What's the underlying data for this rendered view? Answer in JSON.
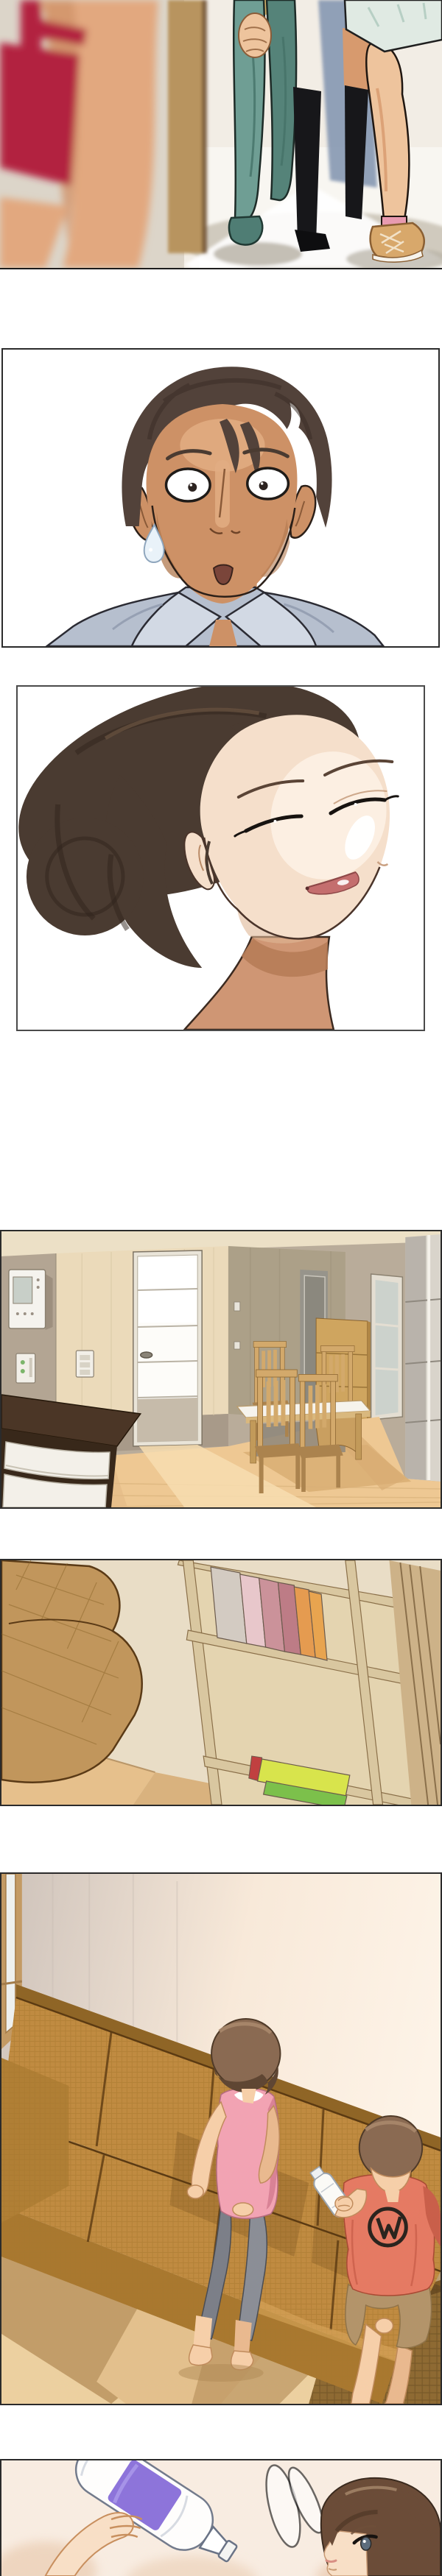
{
  "meta": {
    "type": "webtoon-comic-page",
    "panel_count": 7,
    "text_content": "none - wordless comic panels"
  },
  "icons": [
    "sweat-drop-icon",
    "motion-swirl-icon"
  ],
  "panels": [
    {
      "id": "panel-1",
      "alt": "Blurred woman in a red top in the foreground watching two people walk in through a bright doorway; teal jeans, black knee socks, tan sneaker with pink sock, pale mint skirt"
    },
    {
      "id": "panel-2",
      "alt": "Startled man with wide round eyes, small open mouth and a sweat drop on his cheek, wearing a pale blue collared shirt"
    },
    {
      "id": "panel-3",
      "alt": "Smiling woman with closed eyes, dark brown hair swept into a low bun, rose lips"
    },
    {
      "id": "panel-4",
      "alt": "Empty apartment interior: white paneled door, taupe walls with intercom and switches, wooden dining table with slat-back chairs, white shelving, dark counter with white drawers"
    },
    {
      "id": "panel-5",
      "alt": "Tilted view of a light wood bookshelf holding white, pink, rose and orange books with lime green books below, next to a woven tan sofa"
    },
    {
      "id": "panel-6",
      "alt": "Woman in a pink tank top and gray leggings and a boy in a coral tee holding a white bottle, sitting on a long woven brown sofa against a peach wall"
    },
    {
      "id": "panel-7",
      "alt": "Girl in profile looking up at an upside-down clear bottle with a purple band, with a swirl motion mark beside it"
    }
  ],
  "palette": {
    "paper": "#ffffff",
    "ink": "#241f1a",
    "p1-bg-left": "#dcd5c9",
    "p1-bg-right": "#f2ede5",
    "p1-floor": "#f8f6f1",
    "p1-doorframe": "#b8945f",
    "p1-doorframe-edge": "#6b4e2e",
    "p1-red": "#b22340",
    "p1-skin-blur": "#e2a87f",
    "p1-jeans": "#6f9e94",
    "p1-jeans-dark": "#558379",
    "p1-shoe-teal": "#4f7d74",
    "p1-shadow-blue": "#8093af",
    "p1-skin": "#eec49d",
    "p1-skin-shadow": "#d79a6e",
    "p1-sock-black": "#17171a",
    "p1-skirt": "#e0eae3",
    "p1-sock-pink": "#e89bb0",
    "p1-sneaker": "#d8a86b",
    "p1-shadow-warm": "#c7bfb2",
    "p2-hair": "#52423a",
    "p2-hair-dark": "#3a2e27",
    "p2-skin": "#cd9166",
    "p2-skin-hi": "#e2ad82",
    "p2-skin-sh": "#b0784e",
    "p2-shirt": "#b6bfce",
    "p2-shirt-hi": "#d2d9e4",
    "p2-shirt-sh": "#8e99ad",
    "p2-sweat": "#e9f2f9",
    "p3-hair": "#4a3b31",
    "p3-hair-dark": "#2f241c",
    "p3-skin": "#f5dfcb",
    "p3-skin-hi": "#fdf1e4",
    "p3-skin-sh": "#e0b896",
    "p3-lips": "#c46e6e",
    "p3-neck": "#cf9674",
    "p3-neck-sh": "#b67c58",
    "p4-ceil": "#ece0c6",
    "p4-wall-left": "#b3a593",
    "p4-wall-cream": "#ebdaba",
    "p4-wall-center": "#aca088",
    "p4-wall-lower": "#a89a89",
    "p4-door": "#fdfcf9",
    "p4-door-low": "#c6bbaa",
    "p4-wood": "#cfa55f",
    "p4-wood-dark": "#b08646",
    "p4-chair": "#d3a96b",
    "p4-chair-dark": "#ab834e",
    "p4-floor": "#eec893",
    "p4-floor-sh": "#d9af76",
    "p4-floor-hi": "#f7ddb0",
    "p4-counter": "#4b3626",
    "p4-counter-side": "#38281a",
    "p4-drawer": "#f3f0e9",
    "p4-shelf": "#d9d4cb",
    "p4-shelf-in": "#b9b3ab",
    "p5-wall": "#e9ddc6",
    "p5-floor": "#e6c08c",
    "p5-sofa": "#c1965c",
    "p5-shelf": "#d9c7a0",
    "p5-shelf-in": "#e4d4b0",
    "p5-shelf-edge": "#8a6f49",
    "p5-book-white": "#d3cbc2",
    "p5-book-pink": "#e8c7cb",
    "p5-book-rose": "#cb929a",
    "p5-book-dkrose": "#bd7c86",
    "p5-book-orange": "#e59b50",
    "p5-book-lime": "#d8e44c",
    "p5-book-green": "#7cc04b",
    "p6-wall-left": "#cdc2ba",
    "p6-wall-right": "#f8e9d9",
    "p6-window": "#c39a64",
    "p6-couch": "#c08b41",
    "p6-couch-top": "#8f6526",
    "p6-couch-weave": "#a8772f",
    "p6-couch-line": "#5b3a12",
    "p6-rug": "#8e6a33",
    "p6-rug-line": "#6f5124",
    "p6-floor": "#ecd0a0",
    "p6-floor-sh": "#bb945f",
    "hair-brown": "#8a6a52",
    "hair-brown-dark": "#5f4633",
    "hair-brown-hi": "#a8886b",
    "p6-skin": "#f6cfa9",
    "p6-skin-sh": "#e9b98f",
    "p6-pink": "#f2a3b3",
    "p6-pink-sh": "#d98296",
    "p6-leggings": "#7c7f88",
    "p6-leggings2": "#8b8e96",
    "p6-tee": "#e57a63",
    "p6-tee-sh": "#c95f4a",
    "p6-shorts": "#b3946a",
    "bottle-white": "#fbfaf6",
    "p7-bg": "#f8ece1",
    "p7-blob": "#eed5bf",
    "p7-purple": "#8d74da",
    "p7-hair": "#6b4c38",
    "p7-hair-dark": "#4e3726",
    "p7-skin": "#f8dfc6",
    "p7-outline": "#6a7386"
  }
}
